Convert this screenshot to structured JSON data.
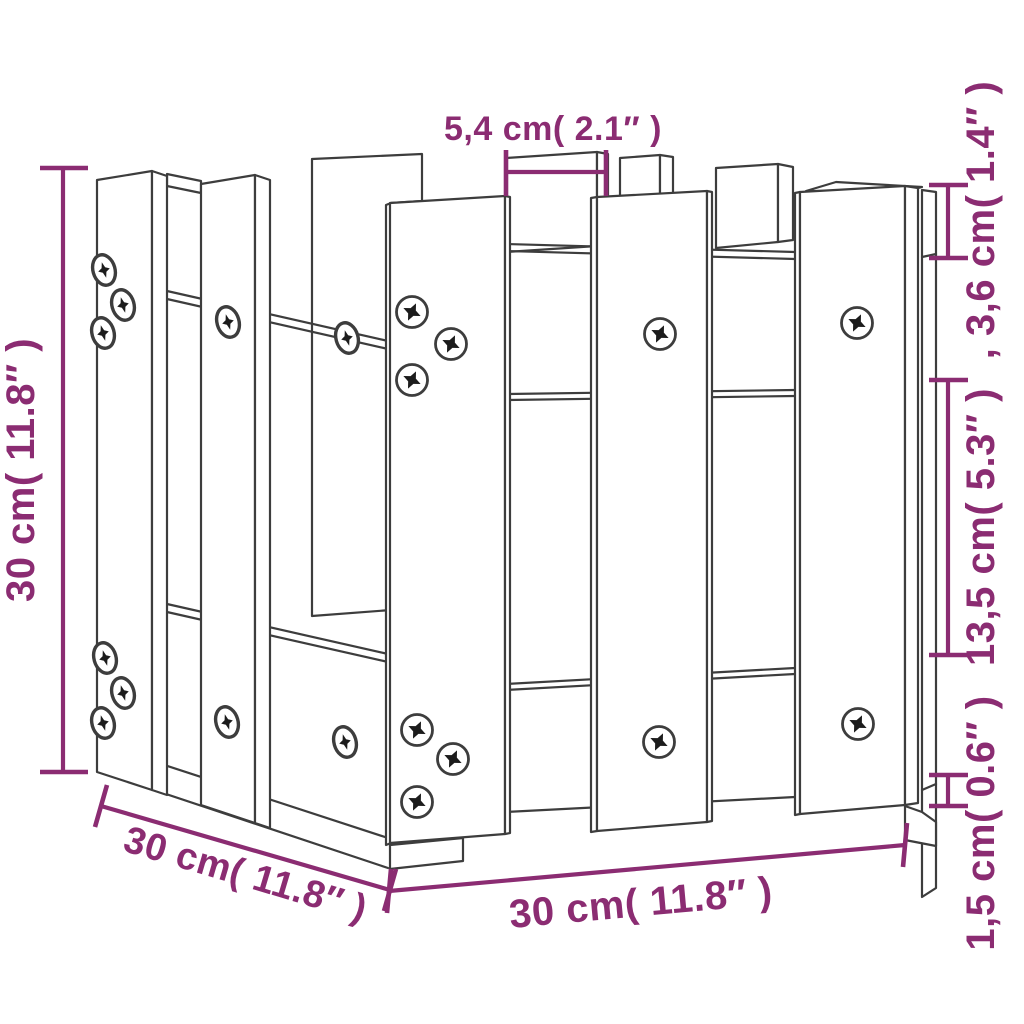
{
  "diagram": {
    "type": "product_dimension_diagram",
    "subject": "wooden garden planter with fence (picket) design, perspective line drawing",
    "background_color": "#ffffff",
    "line_color": "#3d3d3d",
    "accent_color": "#8b2c72",
    "labels": {
      "top_width": "5,4 cm( 2.1″ )",
      "right_top": ",  3,6 cm( 1.4″ )",
      "right_middle": "13,5 cm( 5.3″ )",
      "right_bottom": "1,5 cm( 0.6″ )",
      "left_height": "30 cm( 11.8″ )",
      "bottom_depth": "30 cm( 11.8″ )",
      "bottom_width": "30 cm( 11.8″ )"
    },
    "screw_count": 20
  }
}
